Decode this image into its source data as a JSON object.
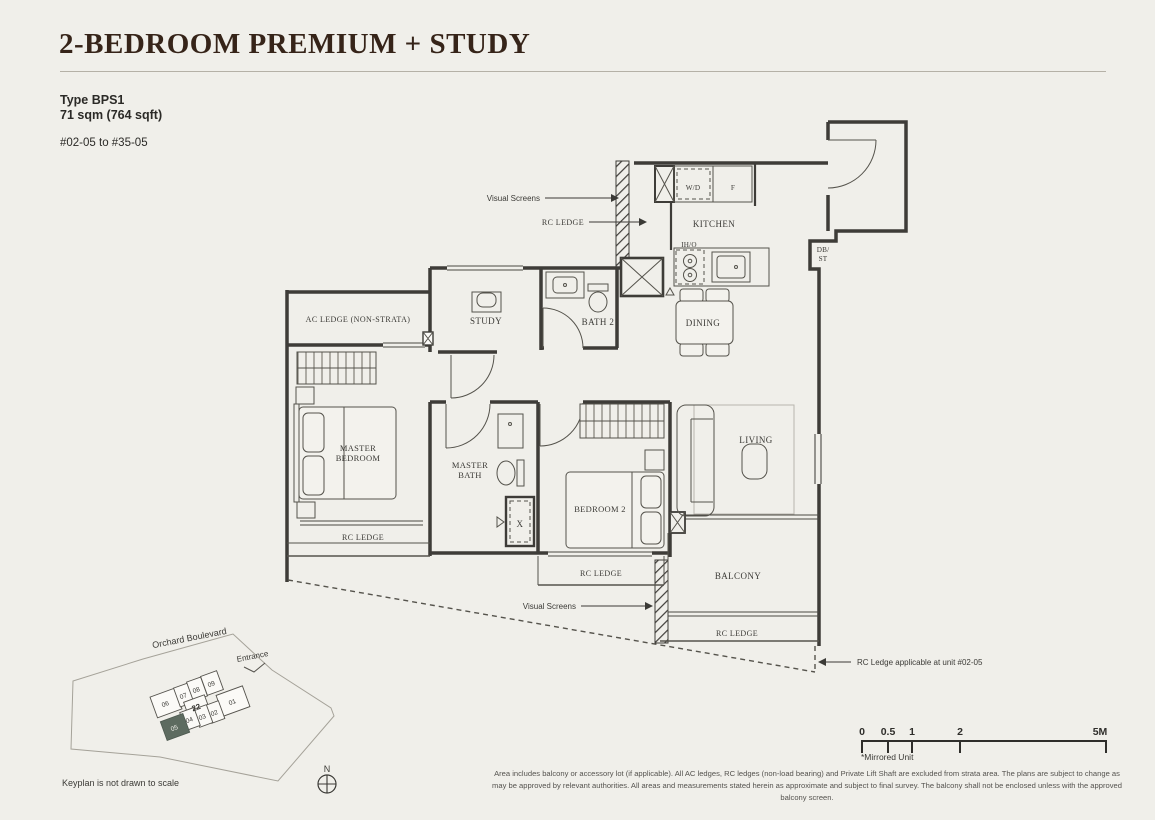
{
  "header": {
    "title": "2-BEDROOM PREMIUM + STUDY",
    "type_label": "Type BPS1",
    "area_label": "71 sqm (764 sqft)",
    "unit_range": "#02-05 to #35-05"
  },
  "plan": {
    "labels": {
      "kitchen": "KITCHEN",
      "wd": "W/D",
      "fridge": "F",
      "iho": "IH/O",
      "db1": "DB/",
      "db2": "ST",
      "dining": "DINING",
      "study": "STUDY",
      "bath2": "BATH 2",
      "ac_ledge": "AC LEDGE (NON-STRATA)",
      "master1": "MASTER",
      "master2": "BEDROOM",
      "mbath1": "MASTER",
      "mbath2": "BATH",
      "bedroom2": "BEDROOM 2",
      "living": "LIVING",
      "balcony": "BALCONY",
      "rc_ledge": "RC LEDGE",
      "x_mark": "X"
    },
    "annotations": {
      "visual_screens": "Visual Screens",
      "rc_ledge_arrow": "RC LEDGE",
      "rc_note": "RC Ledge applicable at unit #02-05"
    }
  },
  "keyplan": {
    "street": "Orchard Boulevard",
    "entrance": "Entrance",
    "units": [
      "06",
      "07",
      "08",
      "09",
      "22",
      "01",
      "02",
      "03",
      "04",
      "05"
    ],
    "highlighted_unit": "05",
    "north": "N",
    "note": "Keyplan is not drawn to scale",
    "highlight_color": "#5d6b60"
  },
  "scalebar": {
    "ticks": [
      "0",
      "0.5",
      "1",
      "2",
      "5M"
    ],
    "note": "*Mirrored Unit"
  },
  "disclaimer": "Area includes balcony or accessory lot (if applicable). All AC ledges, RC ledges (non-load bearing) and Private Lift Shaft are excluded from strata area. The plans are subject to change as may be approved by relevant authorities. All areas and measurements stated herein as approximate and subject to final survey. The balcony shall not be enclosed unless with the approved balcony screen.",
  "colors": {
    "page_background": "#f0efea",
    "title_text": "#362419",
    "wall_line": "#3e3c38",
    "keyplan_highlight": "#5d6b60"
  }
}
